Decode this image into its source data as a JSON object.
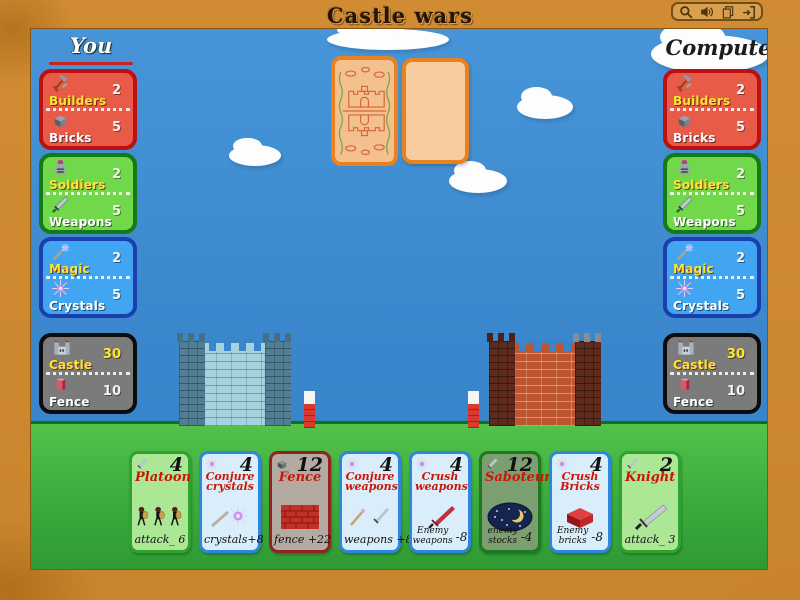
{
  "title": "Castle wars",
  "toolbar": {
    "icons": [
      "search",
      "volume",
      "pages",
      "exit"
    ]
  },
  "colors": {
    "frame": "#d18c33",
    "sky": "#3a86cc",
    "grass": "#3fae3f",
    "builders_panel": "#e85b49",
    "soldiers_panel": "#72d84b",
    "magic_panel": "#42a5f2",
    "castle_panel": "#7b7b7b",
    "card_attack_bg": "#abe795",
    "card_magic_bg": "#d9eefa",
    "card_brick_bg": "#b3aaa1",
    "card_title_red": "#cc1505",
    "label_yellow": "#ffe52e"
  },
  "you": {
    "label": "You",
    "builders": {
      "label": "Builders",
      "value": "2"
    },
    "bricks": {
      "label": "Bricks",
      "value": "5"
    },
    "soldiers": {
      "label": "Soldiers",
      "value": "2"
    },
    "weapons": {
      "label": "Weapons",
      "value": "5"
    },
    "magic": {
      "label": "Magic",
      "value": "2"
    },
    "crystals": {
      "label": "Crystals",
      "value": "5"
    },
    "castle": {
      "label": "Castle",
      "value": "30"
    },
    "fence": {
      "label": "Fence",
      "value": "10"
    }
  },
  "computer": {
    "label": "Computer",
    "builders": {
      "label": "Builders",
      "value": "2"
    },
    "bricks": {
      "label": "Bricks",
      "value": "5"
    },
    "soldiers": {
      "label": "Soldiers",
      "value": "2"
    },
    "weapons": {
      "label": "Weapons",
      "value": "5"
    },
    "magic": {
      "label": "Magic",
      "value": "2"
    },
    "crystals": {
      "label": "Crystals",
      "value": "5"
    },
    "castle": {
      "label": "Castle",
      "value": "30"
    },
    "fence": {
      "label": "Fence",
      "value": "10"
    }
  },
  "hand": {
    "cards": [
      {
        "name": "Platoon",
        "cost": "4",
        "effect": "attack_ 6"
      },
      {
        "name": "Conjure crystals",
        "cost": "4",
        "effect": "crystals+8"
      },
      {
        "name": "Fence",
        "cost": "12",
        "effect": "fence +22"
      },
      {
        "name": "Conjure weapons",
        "cost": "4",
        "effect": "weapons +8"
      },
      {
        "name": "Crush weapons",
        "cost": "4",
        "effect_lines": [
          "Enemy",
          "weapons"
        ],
        "effect_value": "-8"
      },
      {
        "name": "Saboteur",
        "cost": "12",
        "effect_lines": [
          "enemy",
          "stocks"
        ],
        "effect_value": "-4"
      },
      {
        "name": "Crush Bricks",
        "cost": "4",
        "effect_lines": [
          "Enemy",
          "bricks"
        ],
        "effect_value": "-8"
      },
      {
        "name": "Knight",
        "cost": "2",
        "effect": "attack_ 3"
      }
    ]
  }
}
